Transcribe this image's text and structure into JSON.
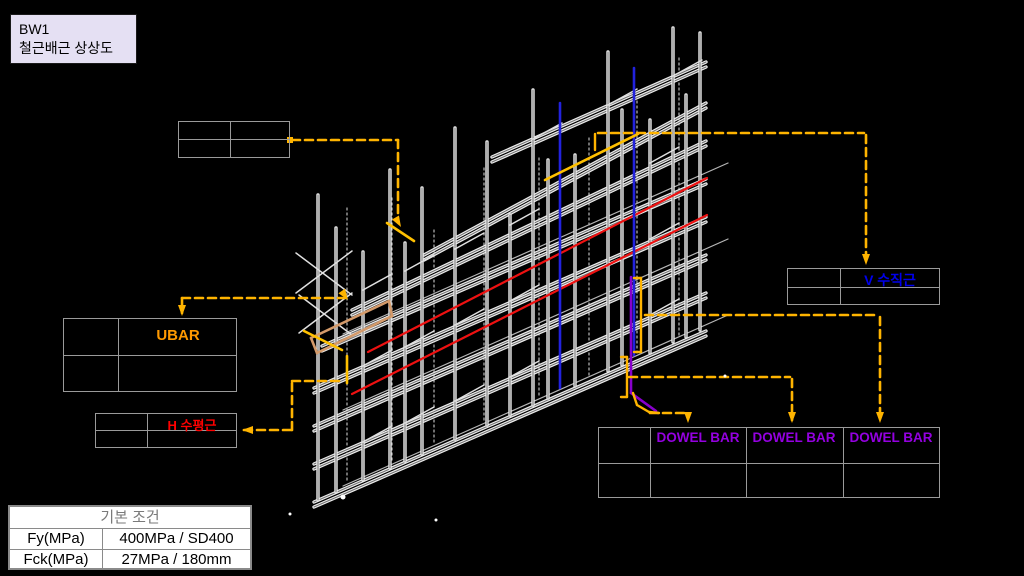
{
  "title_box": {
    "line1": "BW1",
    "line2": "철근배근 상상도"
  },
  "labels": {
    "ubar": "UBAR",
    "h_bar": "H 수평근",
    "v_bar": "V 수직근",
    "dowel_1": "DOWEL BAR",
    "dowel_2": "DOWEL BAR",
    "dowel_3": "DOWEL BAR"
  },
  "conditions_table": {
    "header": "기본 조건",
    "rows": [
      {
        "name": "Fy(MPa)",
        "value": "400MPa / SD400"
      },
      {
        "name": "Fck(MPa)",
        "value": "27MPa / 180mm"
      }
    ]
  },
  "colors": {
    "background": "#000000",
    "leader": "#FFB400",
    "red_bar": "#EE1111",
    "blue_bar": "#2222DD",
    "yellow_bar": "#FFC000",
    "tan_bar": "#D49A6A",
    "purple_bar": "#8800CC",
    "label_ubar": "#FF9900",
    "label_h": "#FF0000",
    "label_v": "#0000EE",
    "label_dowel": "#9400E0",
    "table_line": "#9a9a9a",
    "title_bg": "#E5E0F3",
    "tube_light": "#ececec",
    "tube_core": "#6f6f6f"
  },
  "drawing": {
    "columns": [
      [
        318,
        195,
        500
      ],
      [
        336,
        228,
        492
      ],
      [
        363,
        252,
        480
      ],
      [
        390,
        170,
        468
      ],
      [
        405,
        243,
        461
      ],
      [
        422,
        188,
        454
      ],
      [
        455,
        128,
        439
      ],
      [
        487,
        142,
        425
      ],
      [
        510,
        215,
        415
      ],
      [
        533,
        90,
        405
      ],
      [
        548,
        160,
        398
      ],
      [
        575,
        155,
        386
      ],
      [
        608,
        52,
        371
      ],
      [
        622,
        110,
        365
      ],
      [
        650,
        120,
        353
      ],
      [
        673,
        28,
        342
      ],
      [
        686,
        95,
        337
      ],
      [
        700,
        33,
        330
      ]
    ],
    "rails": [
      [
        314,
        502,
        706,
        331
      ],
      [
        314,
        464,
        706,
        293
      ],
      [
        314,
        426,
        706,
        255
      ],
      [
        314,
        388,
        706,
        217
      ],
      [
        322,
        346,
        706,
        179
      ],
      [
        352,
        310,
        706,
        141
      ],
      [
        424,
        255,
        706,
        103
      ],
      [
        492,
        157,
        706,
        62
      ]
    ],
    "back_columns": [
      [
        347,
        208,
        483
      ],
      [
        392,
        198,
        463
      ],
      [
        434,
        230,
        444
      ],
      [
        484,
        168,
        422
      ],
      [
        539,
        158,
        398
      ],
      [
        589,
        138,
        376
      ],
      [
        637,
        96,
        355
      ],
      [
        679,
        58,
        336
      ]
    ],
    "back_rails": [
      [
        343,
        486,
        728,
        315
      ],
      [
        343,
        410,
        728,
        239
      ],
      [
        343,
        334,
        728,
        163
      ]
    ],
    "ties": [
      [
        363,
        442,
        392,
        426
      ],
      [
        405,
        423,
        434,
        407
      ],
      [
        455,
        401,
        484,
        385
      ],
      [
        510,
        377,
        539,
        361
      ],
      [
        650,
        315,
        679,
        299
      ],
      [
        363,
        366,
        392,
        350
      ],
      [
        405,
        347,
        434,
        331
      ],
      [
        455,
        325,
        484,
        309
      ],
      [
        510,
        301,
        539,
        285
      ],
      [
        650,
        239,
        679,
        223
      ],
      [
        363,
        290,
        392,
        274
      ],
      [
        405,
        271,
        434,
        255
      ],
      [
        455,
        249,
        484,
        233
      ],
      [
        510,
        225,
        539,
        209
      ],
      [
        650,
        163,
        679,
        147
      ],
      [
        533,
        139,
        562,
        123
      ],
      [
        608,
        105,
        637,
        89
      ],
      [
        673,
        76,
        702,
        60
      ]
    ],
    "braces": [
      [
        296,
        293,
        352,
        251
      ],
      [
        296,
        253,
        352,
        295
      ],
      [
        299,
        333,
        352,
        293
      ],
      [
        299,
        295,
        352,
        335
      ]
    ],
    "red_bars": [
      [
        368,
        352,
        707,
        178
      ],
      [
        352,
        394,
        707,
        215
      ]
    ],
    "blue_bars": [
      [
        560,
        103,
        560,
        388
      ],
      [
        634,
        68,
        634,
        355
      ]
    ],
    "yellow_bars": [
      [
        545,
        180,
        638,
        134
      ],
      [
        387,
        223,
        414,
        241
      ],
      [
        304,
        331,
        342,
        350
      ],
      [
        347,
        356,
        347,
        383
      ]
    ],
    "tan_bars": [
      [
        311,
        338,
        389,
        301
      ],
      [
        317,
        353,
        392,
        316
      ],
      [
        311,
        338,
        317,
        353
      ],
      [
        389,
        301,
        392,
        316
      ]
    ],
    "purple_bars": [
      [
        631,
        277,
        631,
        393
      ],
      [
        631,
        393,
        656,
        411
      ]
    ],
    "leader_segs": [
      [
        292,
        140,
        398,
        140
      ],
      [
        398,
        140,
        398,
        220
      ],
      [
        182,
        298,
        182,
        313
      ],
      [
        182,
        298,
        345,
        298
      ],
      [
        244,
        430,
        292,
        430
      ],
      [
        292,
        430,
        292,
        381
      ],
      [
        292,
        381,
        344,
        381
      ],
      [
        598,
        133,
        864,
        133
      ],
      [
        866,
        135,
        866,
        262
      ],
      [
        645,
        315,
        878,
        315
      ],
      [
        880,
        317,
        880,
        420
      ],
      [
        629,
        377,
        790,
        377
      ],
      [
        792,
        379,
        792,
        420
      ],
      [
        650,
        413,
        686,
        413
      ]
    ],
    "solid_orange": [
      [
        641,
        278,
        641,
        352
      ],
      [
        641,
        278,
        634,
        278
      ],
      [
        641,
        352,
        634,
        352
      ],
      [
        627,
        357,
        627,
        397
      ],
      [
        627,
        357,
        621,
        357
      ],
      [
        627,
        397,
        621,
        397
      ],
      [
        633,
        393,
        637,
        405
      ],
      [
        637,
        405,
        649,
        412
      ],
      [
        649,
        412,
        659,
        413
      ],
      [
        595,
        134,
        595,
        150
      ]
    ],
    "arrows": [
      [
        401,
        227,
        60
      ],
      [
        182,
        316,
        90
      ],
      [
        348,
        300,
        55
      ],
      [
        242,
        430,
        180
      ],
      [
        866,
        265,
        90
      ],
      [
        880,
        423,
        90
      ],
      [
        792,
        423,
        90
      ],
      [
        688,
        423,
        90
      ]
    ],
    "dots": [
      [
        343,
        497,
        2.5
      ],
      [
        290,
        514,
        1.5
      ],
      [
        436,
        520,
        1.5
      ],
      [
        725,
        376,
        1.5
      ]
    ],
    "square_dots": [
      [
        287,
        137,
        6
      ]
    ]
  }
}
